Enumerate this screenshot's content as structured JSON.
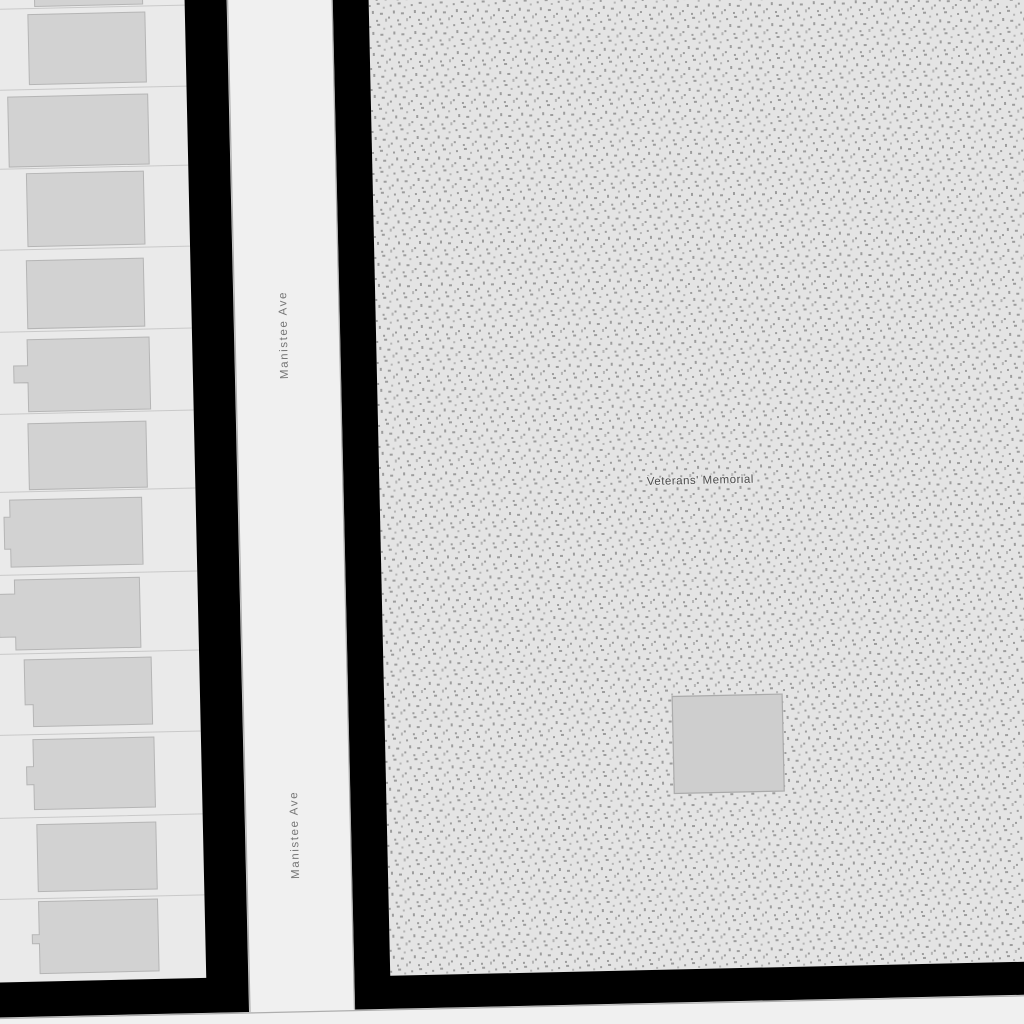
{
  "map": {
    "street_labels": [
      {
        "text": "Manistee Ave"
      },
      {
        "text": "Manistee Ave"
      }
    ],
    "area_label": {
      "text": "Veterans' Memorial"
    },
    "colors": {
      "road": "#f0f0f0",
      "road_casing": "#adadad",
      "parcel": "#eaeaea",
      "parcel_line": "#c9c9c9",
      "building": "#d2d2d2",
      "building_border": "#b5b5b5",
      "block_outline": "#000000",
      "memorial_base": "#e4e4e4",
      "memorial_stipple": "#9c9c9c",
      "memorial_stipple_light": "#b4b4b4",
      "memorial_building": "#cecece",
      "memorial_building_border": "#ababab",
      "street_label": "#767676",
      "area_label": "#4b4b4b"
    }
  }
}
